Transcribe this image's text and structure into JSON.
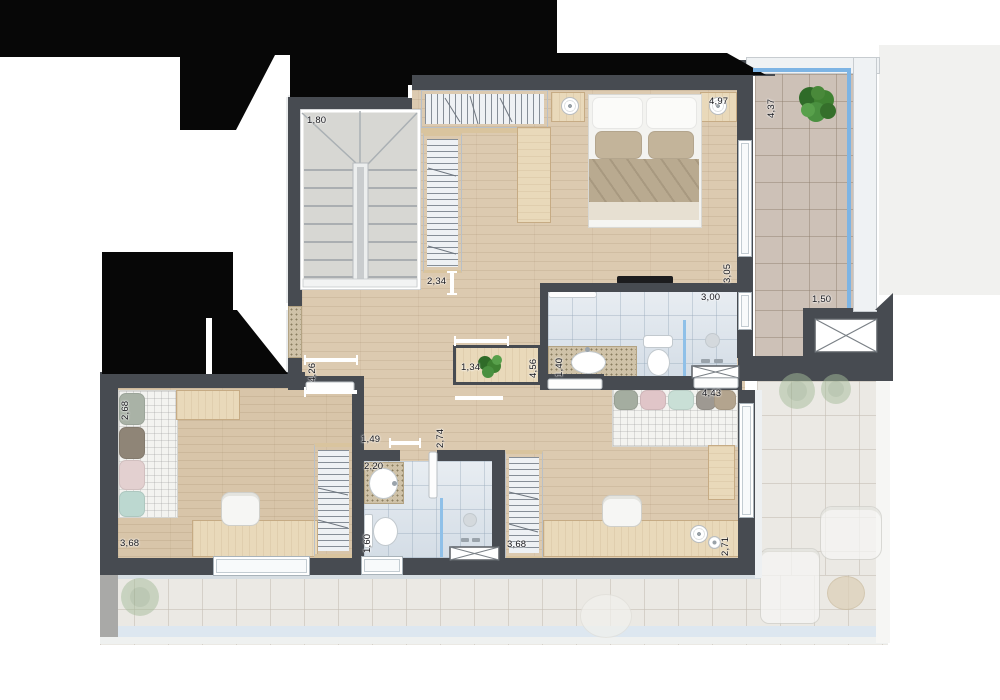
{
  "palette": {
    "wall": "#474b51",
    "mask": "#070707",
    "wood_floor": "#dccab0",
    "bath_tile": "#dfe6ec",
    "balcony_tile": "#cdc1b7",
    "glass_railing": "#7db4e4",
    "plant_green": "#3f8232",
    "granite": "#cfc2a8"
  },
  "icons": {
    "shaft": "crossed-box",
    "plant": "foliage-cluster",
    "stairs": "double-flight-stair"
  },
  "dimensions": {
    "staircase": "1,80",
    "stair_opening": "2,34",
    "master_bedroom": "4,97",
    "balcony_length": "4,37",
    "master_depth": "3,05",
    "master_bath": "3,00",
    "balcony_width": "1,50",
    "hall_length": "4,26",
    "console": "1,34",
    "hall_depth": "4,56",
    "master_bath_depth": "1,40",
    "bedroom2_width": "2,68",
    "bedroom2_length": "3,68",
    "bath2_entry": "1,49",
    "bath2_counter": "2,20",
    "bath2_length": "2,74",
    "bath2_toilet": "1,60",
    "bedroom3_wardrobe": "3,68",
    "bedroom3_width": "4,43",
    "bedroom3_desk": "2,71"
  }
}
